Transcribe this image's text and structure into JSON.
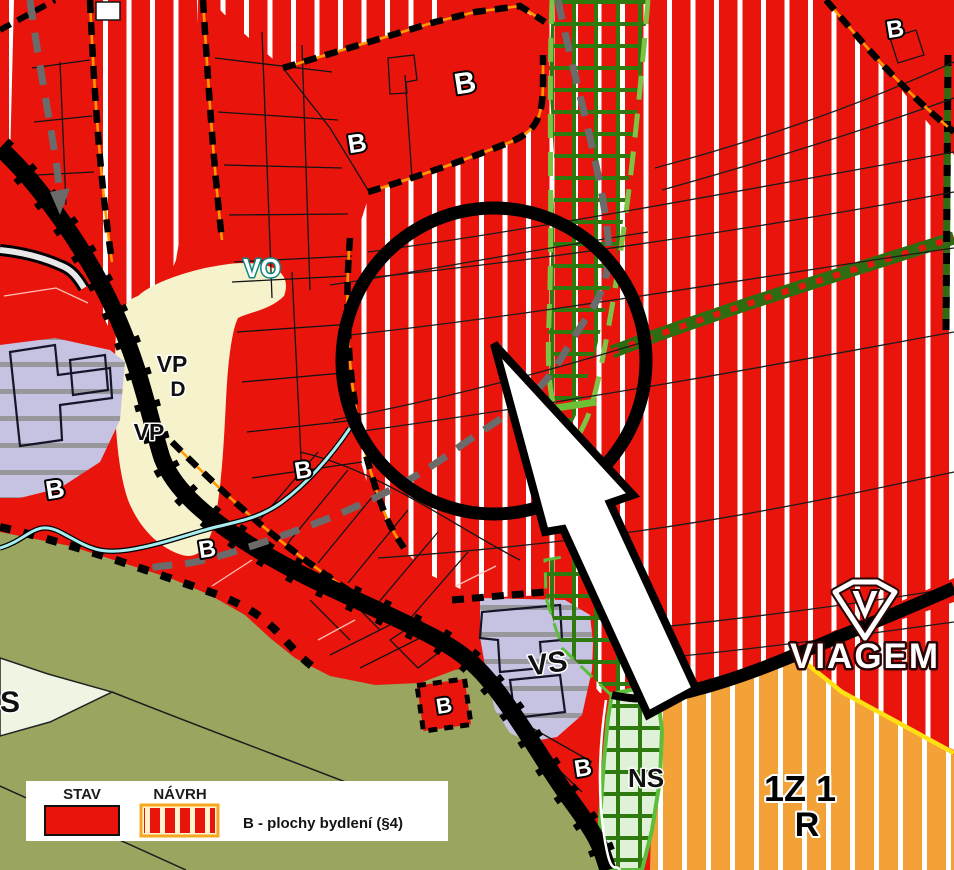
{
  "map": {
    "labels": {
      "housing": "B",
      "public_space": "VP",
      "d_area": "D",
      "public_amenities": "VO",
      "mixed_production": "VS",
      "nature_mixed": "NS",
      "s_area": "S",
      "zone_code_line1": "1Z 1",
      "zone_code_line2": "R"
    },
    "legend": {
      "stav": "STAV",
      "navrh": "NÁVRH",
      "description": "B - plochy bydlení (§4)"
    },
    "watermark": "VIAGEM",
    "colors": {
      "housing_red": "#e9150d",
      "stripe_white": "#ffffff",
      "meadow_olive": "#9aa65f",
      "village_cream": "#f6f2cc",
      "production_lavender": "#c5c3e1",
      "recreation_orange": "#f2a237",
      "nature_light_green": "#dff2d8",
      "nature_grid_green": "#2f7a0e",
      "bright_green": "#5cbe3a",
      "biocorridor_dark_green": "#2f6b10",
      "boundary_orange": "#ff9900",
      "planned_road_gray": "#6b6b6b",
      "water_cyan": "#a8eef0",
      "zone_edge_yellow": "#ffe013",
      "road_black": "#000000"
    }
  }
}
